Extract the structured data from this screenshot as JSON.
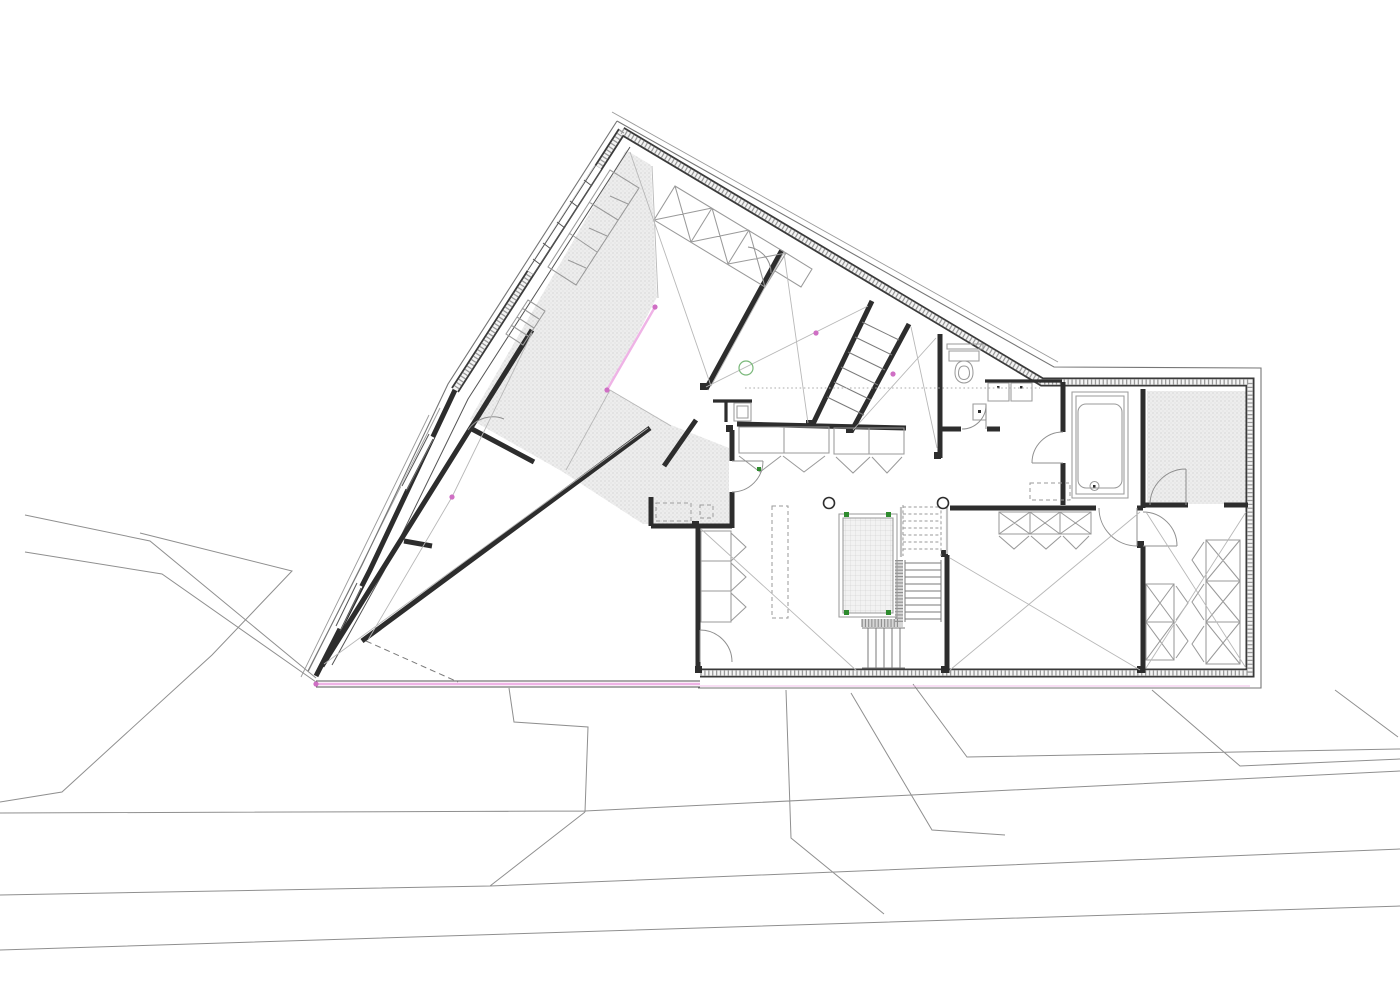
{
  "meta": {
    "drawing_type": "architectural floor plan",
    "canvas": {
      "width": 1400,
      "height": 990
    }
  },
  "colors": {
    "paper": "#ffffff",
    "wall_dark": "#3a3a3a",
    "wall_hatch": "#9a9a9a",
    "site_line": "#8f8f8f",
    "thin_line": "#b8b8b8",
    "shading_dot": "#c9c9c9",
    "shading_bg": "#ededed",
    "pink_accent": "#efb3e6",
    "pink_node": "#cf6fc4",
    "green_accent": "#2e8b2e"
  },
  "elements": {
    "fixtures": [
      "toilet",
      "bathtub",
      "vanity-cabinets",
      "pool-void",
      "stair-flights",
      "round-columns",
      "wardrobes",
      "kitchen-island-dashed",
      "sauna-stipple-room"
    ],
    "annotations": [
      "pink-boundary-line",
      "pink-node-dots",
      "green-corner-marks",
      "stipple-void-band",
      "site-contours",
      "roads"
    ]
  },
  "paths": {
    "site": "M 25,515 L 150,541 L 316,678 M 25,552 L 162,574 L 316,682 M 140,533 L 292,571 L 212,655 L 62,792 L 0,802 M 509,688 L 514,722 L 588,727 L 585,812 M 0,813 L 585,811 L 1400,771 M 0,895 L 490,886 L 1400,849 M 490,886 L 585,812 M 0,950 L 1400,906 M 786,690 L 791,838 L 884,914 M 851,693 L 932,830 L 1005,835 M 913,684 L 967,757 L 1400,749 M 1152,690 L 1240,766 L 1400,759 M 1335,690 L 1398,737",
    "terrace": "M 440,408 L 308,672 M 429,415 L 301,677 M 612,112 L 1058,362",
    "eave": "M 617,121 L 1054,367 L 1261,368 L 1261,688 L 698,688 M 617,121 L 448,384 L 362,565 L 308,671",
    "outerWall": "M 622,131 L 1042,382 L 1250,382 L 1250,673 L 700,673 M 622,131 L 455,390",
    "leftLowerWall": "M 455,390 L 370,570 L 316,676",
    "wingBottom": "M 316,681 L 700,681 M 316,687 L 700,687",
    "innerLeaf": "M 630,147 L 468,399 L 384,571 L 332,665",
    "interiorWalls": "M 322,666 L 532,330 M 362,641 L 650,428 M 470,428 L 534,462 M 404,541 L 432,546 M 651,497 L 651,526 M 651,526 L 732,526 M 698,528 L 698,673 M 732,430 L 732,461 M 732,492 L 732,528 M 664,466 L 696,420 M 737,424 L 906,428 M 782,250 L 706,389 M 872,301 L 812,426 M 909,324 L 851,432 M 940,334 L 940,458 M 940,429 L 961,429 M 987,429 L 1000,429 M 950,508 L 1096,508 M 1137,508 L 1143,508 M 1143,389 L 1143,508 M 1143,505 L 1188,505 M 1224,505 L 1248,505 M 1143,546 L 1143,673 M 947,555 L 947,673 M 1063,382 L 1063,432 M 1063,463 L 1063,505",
    "interiorMed": "M 985,381 L 1062,381 M 713,401 L 752,401 M 726,401 L 726,422",
    "wallCaps": "M 700,383 h7 v7 h-7 Z M 806,420 h7 v7 h-7 Z M 846,426 h7 v7 h-7 Z M 934,452 h7 v7 h-7 Z M 726,425 h7 v7 h-7 Z M 692,521 h7 v7 h-7 Z M 1137,541 h7 v7 h-7 Z M 941,550 h7 v7 h-7 Z M 941,666 h7 v7 h-7 Z M 1137,666 h7 v7 h-7 Z M 695,666 h7 v7 h-7 Z M 997,386 h2.5 v2.5 h-2.5 Z M 1020,386 h2.5 v2.5 h-2.5 Z M 978,410 h3 v3 h-3 Z M 1093,485 h2.5 v2.5 h-2.5 Z",
    "windowMask": "M 431,436 L 404,488 M 359,585 L 338,628 M 598,167 L 530,272",
    "windowLines": "M 429,434 L 402,486 M 433,439 L 406,491 M 357,583 L 336,626 M 361,588 L 340,631 M 596,165 L 528,270 M 601,171 L 533,275",
    "windowTicks": "M 584,180 L 592,186 M 570,201 L 578,207 M 557,222 L 565,228 M 543,243 L 551,249 M 533,259 L 541,265",
    "bandFill": "M 626,150 L 651,165 L 657,297 L 609,389 L 671,425 L 729,448 L 729,524 L 643,524 L 563,472 L 470,419 Z",
    "saunaFill": "M 1147,391 h100 v113 h-100 Z",
    "poolFill": "M 843,518 h50 v95 h-50 Z",
    "lband": "M 899,560 L 899,623 L 861,623",
    "furn": "M 739,427 h90 v26 h-90 Z M 784,427 v26 M 834,428 h70 v26 h-70 Z M 869,428 v26 M 739,456 L 760,472 L 781,456 M 783,456 L 804,472 L 825,456 M 836,457 L 853,473 L 870,457 M 872,457 L 887,473 L 902,457 M 701,531 h30 v91 h-30 Z M 701,561 h30 M 701,591 h30 M 731,533 L 746,547 L 731,561 M 731,563 L 746,577 L 731,591 M 731,593 L 746,607 L 731,621 M 1146,584 h28 v76 h-28 Z M 1146,622 h28 M 1146,584 L 1174,622 M 1174,584 L 1146,622 M 1146,622 L 1174,660 M 1174,622 L 1146,660 M 1176,586 L 1188,603 L 1176,620 M 1176,624 L 1188,641 L 1176,658 M 1206,540 h34 v124 h-34 Z M 1206,581 h34 M 1206,622 h34 M 1206,540 L 1240,581 M 1240,540 L 1206,581 M 1206,581 L 1240,622 M 1240,581 L 1206,622 M 1206,622 L 1240,664 M 1240,622 L 1206,664 M 1204,542 L 1192,560 L 1204,578 M 1204,584 L 1192,602 L 1204,620 M 1204,626 L 1192,644 L 1204,662 M 999,512 h92 v22 h-92 Z M 1030,512 v22 M 1060,512 v22 M 999,512 L 1030,534 M 1030,512 L 999,534 M 1030,512 L 1060,534 M 1060,512 L 1030,534 M 1060,512 L 1091,534 M 1091,512 L 1060,534 M 999,536 L 1014,549 L 1029,536 M 1031,536 L 1046,549 L 1061,536 M 1063,536 L 1076,549 L 1089,536 M 988,383 h21 v18 h-21 Z M 1011,383 h21 v18 h-21 Z M 973,404 h13 v16 h-13 Z M 949,351 h30 v10 h-30 Z M 947,344 h36 v5 h-36 Z M 964,361 c8,0 9,7 9,12 c0,6 -4,10 -9,10 c-5,0 -9,-4 -9,-10 c0,-5 1,-12 9,-12 Z M 964,366 c4.5,0 5.5,4 5.5,7.5 c0,3.5 -2.2,6 -5.5,6 c-3.3,0 -5.5,-2.5 -5.5,-6 c0,-3.5 1,-7.5 5.5,-7.5 Z M 1072,392 h56 v106 h-56 Z M 1076,396 h48 v98 h-48 Z M 1086,404 h28 a8,8 0 0 1 8,8 v68 a8,8 0 0 1 -8,8 h-28 a8,8 0 0 1 -8,-8 v-68 a8,8 0 0 1 8,-8 Z M 1090,486 a4.5,4.5 0 1 0 9,0 a4.5,4.5 0 1 0 -9,0 M 839,514 h58 v103 h-58 Z M 843,518 h50 v95 h-50 Z M 610,170 L 548,267 L 576,285 L 639,188 Z M 589,202 L 618,220 M 569,233 L 597,252 M 628,204 L 610,196 M 607,236 L 589,228 M 586,268 L 568,260 M 675,186 L 786,253 L 765,287 L 654,220 Z M 712,208 L 691,242 M 749,230 L 728,264 M 675,186 L 691,242 M 712,208 L 654,220 M 712,208 L 728,264 M 749,230 L 691,242 M 749,230 L 765,287 M 786,253 L 728,264 M 786,253 L 812,269 L 801,287 L 775,271 Z M 734,403 h17 v18 h-17 Z M 737,406 h11 v12 h-11 Z M 528,300 L 545,311 L 523,345 L 506,334 Z M 522,308 L 539,319 M 517,317 L 534,328 M 511,325 L 528,336",
    "furnDashed": "M 772,506 h16 v112 h-16 Z M 656,503 h35 v18 h-35 Z M 700,505 h13 v13 h-13 Z M 1030,483 h40 v17 h-40 Z",
    "stairSolid": "M 905,563 L 941,563 M 905,570 L 941,570 M 905,577 L 941,577 M 905,584 L 941,584 M 905,591 L 941,591 M 905,598 L 941,598 M 905,605 L 941,605 M 905,612 L 941,612 M 905,619 L 941,619 M 905,560 L 905,622 M 941,560 L 941,622 M 868,628 L 868,668 M 876,628 L 876,668 M 884,628 L 884,668 M 892,628 L 892,668 M 900,628 L 900,668 M 862,628 L 905,628 M 862,668 L 905,668 M 862,322 L 899,340 M 855,337 L 892,355 M 848,352 L 885,370 M 841,367 L 878,385 M 834,382 L 871,400 M 827,397 L 864,415",
    "stairDashed": "M 903,507 L 941,507 M 903,514 L 941,514 M 903,521 L 941,521 M 903,528 L 941,528 M 903,535 L 941,535 M 903,542 L 941,542 M 903,549 L 941,549 M 903,505 L 903,556 M 941,505 L 941,556",
    "doorArcs": "M 763,461 A 31 31 0 0 1 732,492 M 732,461 L 763,461 M 700,630 A 32 32 0 0 1 732,662 M 700,630 L 700,662 M 986,405 A 24 24 0 0 1 962,429 M 986,429 L 986,405 M 1032,463 A 31 31 0 0 1 1063,432 M 1063,463 L 1032,463 M 1099,508 A 38 38 0 0 0 1137,546 M 1137,508 L 1137,546 M 1143,512 A 34 34 0 0 1 1177,546 M 1143,546 L 1177,546 M 1150,505 A 36 36 0 0 1 1186,469 M 1186,505 L 1186,469 M 748,247 A 26 26 0 0 1 771,273 M 468,430 A 30 30 0 0 1 504,419",
    "thinLines": "M 630,152 L 711,386 M 711,386 L 784,252 M 784,253 L 808,423 M 706,387 L 868,306 M 911,327 L 937,448 M 853,430 L 936,338 M 324,664 L 648,428 M 452,497 L 368,640 M 452,497 L 532,333 M 701,529 L 858,672 M 950,558 L 1140,670 M 1140,512 L 950,670 M 1146,512 L 1246,668 M 1246,512 L 1146,668 M 610,390 L 566,470 M 610,390 L 671,426 M 652,166 L 658,298",
    "dottedLines": "M 745,388 L 1040,388",
    "tipDashed": "M 366,641 L 458,682",
    "balustrade": "M 947,505 L 947,554 M 901,507 L 901,557",
    "columns": "M 823.5,503 a5.5,5.5 0 1 0 11,0 a5.5,5.5 0 1 0 -11,0 M 937.5,503 a5.5,5.5 0 1 0 11,0 a5.5,5.5 0 1 0 -11,0",
    "pinkMain": "M 316,684 L 700,684 M 655,307 L 607,390",
    "pinkFaint": "M 700,686 L 1250,686",
    "pinkDots": "M 652.4,307 a2.6,2.6 0 1 0 5.2,0 a2.6,2.6 0 1 0 -5.2,0 M 604.4,390 a2.6,2.6 0 1 0 5.2,0 a2.6,2.6 0 1 0 -5.2,0 M 813.4,333 a2.6,2.6 0 1 0 5.2,0 a2.6,2.6 0 1 0 -5.2,0 M 890.4,374 a2.6,2.6 0 1 0 5.2,0 a2.6,2.6 0 1 0 -5.2,0 M 449.4,497 a2.6,2.6 0 1 0 5.2,0 a2.6,2.6 0 1 0 -5.2,0 M 313.4,684 a2.6,2.6 0 1 0 5.2,0 a2.6,2.6 0 1 0 -5.2,0",
    "greenMarks": "M 844,512 h5 v5 h-5 Z M 886,512 h5 v5 h-5 Z M 844,610 h5 v5 h-5 Z M 886,610 h5 v5 h-5 Z M 757,467 h4 v4 h-4 Z",
    "greenCircle": "M 739,368 a7,7 0 1 0 14,0 a7,7 0 1 0 -14,0"
  }
}
